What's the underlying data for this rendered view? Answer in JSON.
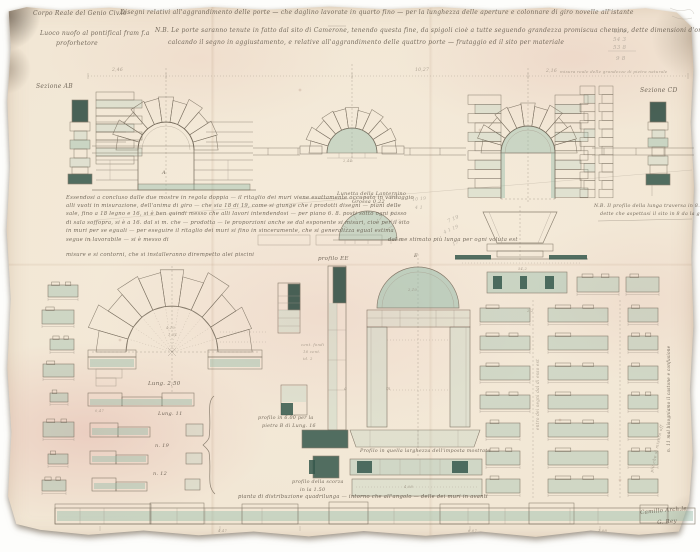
{
  "palette": {
    "paper": "#f2e7d5",
    "stain": "#eccfc4",
    "ink": "#776c5d",
    "ink_faint": "#a3988a",
    "wash_teal": "#93bba9",
    "wash_teal_light": "#b9d2c5",
    "wash_teal_dark": "#35584c",
    "wash_teal_deep": "#2b4a40",
    "pencil": "#a8a095"
  },
  "labels": [
    {
      "name": "office-stamp",
      "t": "Corpo Reale del Genio Civ.le",
      "x": 33,
      "y": 11,
      "s": 6
    },
    {
      "name": "main-title",
      "t": "Disegni relativi all'aggrandimento delle porte — che daglino lavorate in quarto fino — per la lunghezza delle aperture e colonnare di giro novelle all'istante",
      "x": 120,
      "y": 10,
      "s": 6
    },
    {
      "name": "subtitle-line-1",
      "t": "Luoco nuofo al pontifical fram f.a",
      "x": 40,
      "y": 31,
      "s": 6
    },
    {
      "name": "subtitle-line-2",
      "t": "proforhetore",
      "x": 56,
      "y": 41,
      "s": 6
    },
    {
      "name": "nb-note-line-1",
      "t": "N.B. Le porte saranno tenute in fatto dal sito di Camerone, tenendo questa fine, da spigoli cioè a tutte seguendo grandezza promiscua chemins, dette dimensioni d'ordine segnate in rosso",
      "x": 155,
      "y": 28,
      "s": 6
    },
    {
      "name": "nb-note-line-2",
      "t": "calcando il segno in aggiustamento, e relative all'aggrandimento delle quattro porte — frutaggio ed il sito per materiale",
      "x": 168,
      "y": 40,
      "s": 6
    },
    {
      "name": "pencil-sum-1",
      "t": "43 6",
      "x": 613,
      "y": 29,
      "s": 5.5,
      "c": "pencil"
    },
    {
      "name": "pencil-sum-2",
      "t": "54 3",
      "x": 613,
      "y": 37,
      "s": 5.5,
      "c": "pencil"
    },
    {
      "name": "pencil-sum-3",
      "t": "53 8",
      "x": 613,
      "y": 45,
      "s": 5.5,
      "c": "pencil"
    },
    {
      "name": "pencil-sum-total",
      "t": "9 8",
      "x": 616,
      "y": 56,
      "s": 5.5,
      "c": "pencil"
    },
    {
      "name": "dim-2-46",
      "t": "2,46",
      "x": 112,
      "y": 68,
      "s": 4.5,
      "c": "faint"
    },
    {
      "name": "dim-10-27",
      "t": "10,27",
      "x": 415,
      "y": 68,
      "s": 4.5,
      "c": "faint"
    },
    {
      "name": "dim-2-16",
      "t": "2,16",
      "x": 546,
      "y": 69,
      "s": 4.5,
      "c": "faint"
    },
    {
      "name": "scale-note",
      "t": "misura reale delle grandezze di pietra naturale",
      "x": 560,
      "y": 70,
      "s": 4,
      "c": "faint"
    },
    {
      "name": "section-ab-label",
      "t": "Sezione AB",
      "x": 36,
      "y": 84,
      "s": 6
    },
    {
      "name": "section-cd-label",
      "t": "Sezione CD",
      "x": 640,
      "y": 88,
      "s": 6
    },
    {
      "name": "letter-a",
      "t": "A",
      "x": 162,
      "y": 171,
      "s": 5
    },
    {
      "name": "annotation-line-1",
      "t": "Essendosi a concluso dalle due mostre in regola doppia — il ritaglio dei muri viene esattamente occupato in vantaggio",
      "x": 66,
      "y": 195,
      "s": 5.3
    },
    {
      "name": "annotation-line-2",
      "t": "alli vuoti in misurazione, dell'anima di giro — che sia 18 di 19, come si giunge che i prodotti disegni — piani delle",
      "x": 66,
      "y": 203.2,
      "s": 5.3
    },
    {
      "name": "annotation-line-3",
      "t": "sale, fino a 18 legno e 16, si è ben quindi messo che alli lavori intendendosi — per piano 6. 8. posti sotto ogni passo",
      "x": 66,
      "y": 211.4,
      "s": 5.3
    },
    {
      "name": "annotation-line-4",
      "t": "di sala soffopra, si è a 16. dal si m. che — prodotta — le proporzioni anche se dal esponente si misuri, cioè per il sito",
      "x": 66,
      "y": 219.6,
      "s": 5.3
    },
    {
      "name": "annotation-line-5",
      "t": "in muri per se eguali — per eseguire il ritaglio dei muri si fino in sinceramente, che si generalizza egual estima",
      "x": 66,
      "y": 227.8,
      "s": 5.3
    },
    {
      "name": "annotation-line-6a",
      "t": "segue in lavorabile — si è messo di",
      "x": 66,
      "y": 236.5,
      "s": 5.3
    },
    {
      "name": "annotation-line-6b",
      "t": "dal me stimato più lunga per ogni voluta est",
      "x": 388,
      "y": 236.5,
      "s": 5.3
    },
    {
      "name": "annotation-line-7",
      "t": "misure e si contorni, che si installeranno dirempetto alei piscini",
      "x": 66,
      "y": 252,
      "s": 5.3
    },
    {
      "name": "lunette-label-1",
      "t": "Lunetta della Lanternino",
      "x": 337,
      "y": 192,
      "s": 5
    },
    {
      "name": "lunette-label-2",
      "t": "Grossa 0,22",
      "x": 352,
      "y": 200,
      "s": 5
    },
    {
      "name": "nb-right-1",
      "t": "N.B. Il profilo della lunga traversa in 8.8 nelle doghe",
      "x": 594,
      "y": 204,
      "s": 4.8
    },
    {
      "name": "nb-right-2",
      "t": "dette che aspettasi il sito in 8 da la giunsa",
      "x": 600,
      "y": 212,
      "s": 4.8
    },
    {
      "name": "pencil-col-1",
      "t": "4 9",
      "x": 390,
      "y": 196,
      "s": 4.5,
      "c": "pencil"
    },
    {
      "name": "pencil-col-2",
      "t": "4 3",
      "x": 390,
      "y": 204,
      "s": 4.5,
      "c": "pencil"
    },
    {
      "name": "pencil-col-3",
      "t": "4 1",
      "x": 390,
      "y": 212,
      "s": 4.5,
      "c": "pencil"
    },
    {
      "name": "pencil-col-4",
      "t": "4 13",
      "x": 390,
      "y": 220,
      "s": 4.5,
      "c": "pencil"
    },
    {
      "name": "pencil-pair-1",
      "t": "10 19",
      "x": 412,
      "y": 198,
      "s": 4.5,
      "c": "pencil",
      "r": -6
    },
    {
      "name": "pencil-pair-2",
      "t": "4 1",
      "x": 415,
      "y": 206,
      "s": 4.5,
      "c": "pencil"
    },
    {
      "name": "pencil-diag-1",
      "t": "7 19",
      "x": 447,
      "y": 220,
      "s": 5,
      "c": "pencil",
      "r": -24
    },
    {
      "name": "pencil-diag-2",
      "t": "4 1 19",
      "x": 443,
      "y": 231,
      "s": 4.5,
      "c": "pencil",
      "r": -24
    },
    {
      "name": "pencil-diag-3",
      "t": "17",
      "x": 452,
      "y": 243,
      "s": 4.5,
      "c": "pencil",
      "r": -24
    },
    {
      "name": "dim-2-44",
      "t": "2,44",
      "x": 343,
      "y": 159,
      "s": 3.6,
      "c": "faint"
    },
    {
      "name": "dim-4-10",
      "t": "4,10",
      "x": 166,
      "y": 326,
      "s": 3.6,
      "c": "faint"
    },
    {
      "name": "dim-1-54",
      "t": "1,54",
      "x": 168,
      "y": 333,
      "s": 3.6,
      "c": "faint"
    },
    {
      "name": "row-long-250",
      "t": "Lung. 2,50",
      "x": 148,
      "y": 381,
      "s": 5.5
    },
    {
      "name": "row-lung-11",
      "t": "Lung. 11",
      "x": 158,
      "y": 412,
      "s": 5
    },
    {
      "name": "row-n-19",
      "t": "n. 19",
      "x": 155,
      "y": 444,
      "s": 5
    },
    {
      "name": "row-n-12",
      "t": "n. 12",
      "x": 153,
      "y": 472,
      "s": 5
    },
    {
      "name": "dim-0-47",
      "t": "0,47",
      "x": 95,
      "y": 409,
      "s": 3.6,
      "c": "faint"
    },
    {
      "name": "profilo-ee-label",
      "t": "profilo EE",
      "x": 318,
      "y": 256,
      "s": 5.5
    },
    {
      "name": "micro-note-1",
      "t": "cent. fondi",
      "x": 301,
      "y": 343,
      "s": 3.8,
      "c": "faint"
    },
    {
      "name": "micro-note-2",
      "t": "16 cent.",
      "x": 303,
      "y": 350,
      "s": 3.8,
      "c": "faint"
    },
    {
      "name": "micro-note-3",
      "t": "id. 2",
      "x": 303,
      "y": 357,
      "s": 3.8,
      "c": "faint"
    },
    {
      "name": "profilo-600-1",
      "t": "profilo in 6.00 per la",
      "x": 258,
      "y": 416,
      "s": 4.8
    },
    {
      "name": "profilo-600-2",
      "t": "pietra B di Lung. 16",
      "x": 262,
      "y": 424,
      "s": 4.8
    },
    {
      "name": "profilo-scorza-1",
      "t": "profilo della scorza",
      "x": 292,
      "y": 480,
      "s": 4.8
    },
    {
      "name": "profilo-scorza-2",
      "t": "in la 1.50",
      "x": 300,
      "y": 488,
      "s": 4.8
    },
    {
      "name": "letter-e",
      "t": "E",
      "x": 414,
      "y": 254,
      "s": 5
    },
    {
      "name": "dim-2-10",
      "t": "2,10",
      "x": 408,
      "y": 288,
      "s": 3.6,
      "c": "faint"
    },
    {
      "name": "letter-m",
      "t": "m",
      "x": 386,
      "y": 387,
      "s": 4.5,
      "c": "faint"
    },
    {
      "name": "letter-a2",
      "t": "a",
      "x": 344,
      "y": 387,
      "s": 4.5,
      "c": "faint"
    },
    {
      "name": "dim-54-2",
      "t": "54,2",
      "x": 518,
      "y": 267,
      "s": 3.6,
      "c": "faint"
    },
    {
      "name": "dim-2-2",
      "t": "2,2",
      "x": 527,
      "y": 309,
      "s": 3.6,
      "c": "faint"
    },
    {
      "name": "imposta-label",
      "t": "Profilo in quella larghezza dell'imposta mostrata",
      "x": 360,
      "y": 449,
      "s": 4.8
    },
    {
      "name": "dim-4-08",
      "t": "4,08",
      "x": 404,
      "y": 485,
      "s": 3.6,
      "c": "faint"
    },
    {
      "name": "vertical-note-center",
      "t": "entro dei segni dal di esso est",
      "x": 536,
      "y": 430,
      "s": 4.2,
      "c": "faint",
      "r": -90
    },
    {
      "name": "vertical-note-right",
      "t": "n. 11 mal bisogniamo il castone e confusione",
      "x": 667,
      "y": 452,
      "s": 4.2,
      "r": -90
    },
    {
      "name": "vertical-note-right-2",
      "t": "più che si misura off",
      "x": 650,
      "y": 472,
      "s": 4.2,
      "c": "faint",
      "r": -78
    },
    {
      "name": "bottom-plan-label",
      "t": "pianta di distribuzione quadrilunga — intorno che all'angolo — delle dei muri in avanti",
      "x": 238,
      "y": 495,
      "s": 5.2
    },
    {
      "name": "strip-dim-1",
      "t": "4,47",
      "x": 218,
      "y": 529,
      "s": 3.6,
      "c": "faint"
    },
    {
      "name": "strip-dim-2",
      "t": "6,07",
      "x": 468,
      "y": 529,
      "s": 3.6,
      "c": "faint"
    },
    {
      "name": "strip-dim-3",
      "t": "1,08",
      "x": 598,
      "y": 529,
      "s": 3.6,
      "c": "faint"
    },
    {
      "name": "signature-line-1",
      "t": "Camillo Arch.le",
      "x": 640,
      "y": 510,
      "s": 5.5,
      "r": -5
    },
    {
      "name": "signature-line-2",
      "t": "G. Rey",
      "x": 657,
      "y": 520,
      "s": 5.5,
      "r": -5
    }
  ]
}
